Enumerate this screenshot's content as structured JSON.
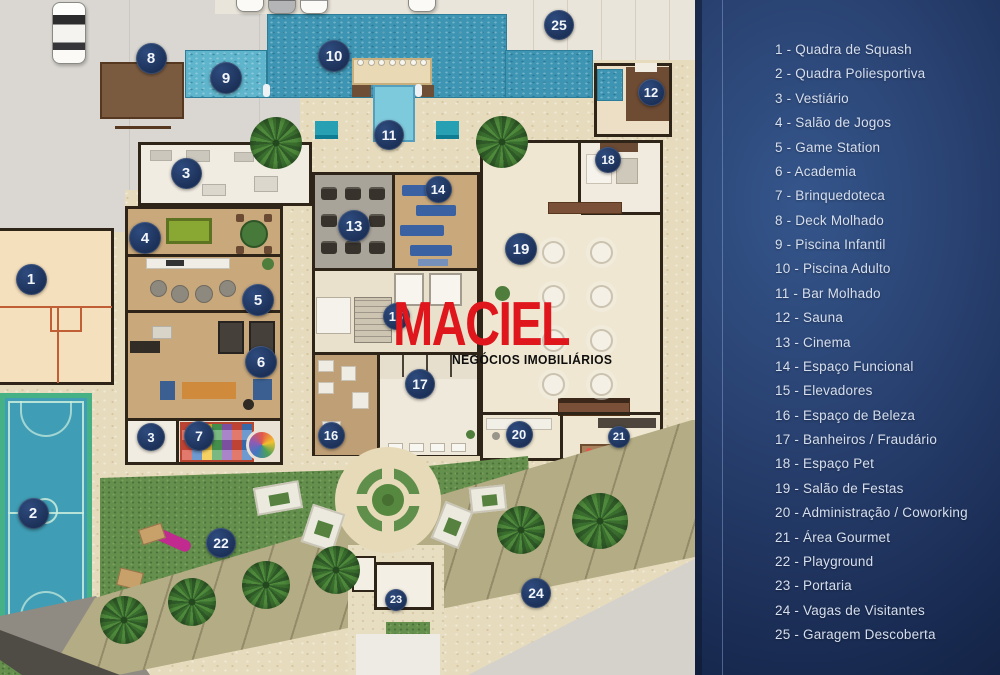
{
  "watermark": {
    "brand": "MACIEL",
    "tagline": "NEGÓCIOS IMOBILIÁRIOS"
  },
  "legend": {
    "separator": " - ",
    "items": [
      {
        "n": "1",
        "label": "Quadra de Squash"
      },
      {
        "n": "2",
        "label": "Quadra Poliesportiva"
      },
      {
        "n": "3",
        "label": "Vestiário"
      },
      {
        "n": "4",
        "label": "Salão de Jogos"
      },
      {
        "n": "5",
        "label": "Game Station"
      },
      {
        "n": "6",
        "label": "Academia"
      },
      {
        "n": "7",
        "label": "Brinquedoteca"
      },
      {
        "n": "8",
        "label": "Deck Molhado"
      },
      {
        "n": "9",
        "label": "Piscina Infantil"
      },
      {
        "n": "10",
        "label": "Piscina Adulto"
      },
      {
        "n": "11",
        "label": "Bar Molhado"
      },
      {
        "n": "12",
        "label": "Sauna"
      },
      {
        "n": "13",
        "label": "Cinema"
      },
      {
        "n": "14",
        "label": "Espaço Funcional"
      },
      {
        "n": "15",
        "label": "Elevadores"
      },
      {
        "n": "16",
        "label": "Espaço de Beleza"
      },
      {
        "n": "17",
        "label": "Banheiros / Fraudário"
      },
      {
        "n": "18",
        "label": "Espaço Pet"
      },
      {
        "n": "19",
        "label": "Salão de Festas"
      },
      {
        "n": "20",
        "label": "Administração / Coworking"
      },
      {
        "n": "21",
        "label": "Área Gourmet"
      },
      {
        "n": "22",
        "label": "Playground"
      },
      {
        "n": "23",
        "label": "Portaria"
      },
      {
        "n": "24",
        "label": "Vagas de Visitantes"
      },
      {
        "n": "25",
        "label": "Garagem Descoberta"
      }
    ]
  },
  "plan": {
    "badges": [
      {
        "n": "1",
        "x": 31,
        "y": 279,
        "s": 31
      },
      {
        "n": "2",
        "x": 33,
        "y": 513,
        "s": 31
      },
      {
        "n": "3",
        "x": 186,
        "y": 173,
        "s": 31
      },
      {
        "n": "4",
        "x": 145,
        "y": 238,
        "s": 32
      },
      {
        "n": "5",
        "x": 258,
        "y": 300,
        "s": 32
      },
      {
        "n": "6",
        "x": 261,
        "y": 362,
        "s": 32
      },
      {
        "n": "3",
        "x": 151,
        "y": 437,
        "s": 28
      },
      {
        "n": "7",
        "x": 199,
        "y": 436,
        "s": 30
      },
      {
        "n": "8",
        "x": 151,
        "y": 58,
        "s": 31
      },
      {
        "n": "9",
        "x": 226,
        "y": 78,
        "s": 32
      },
      {
        "n": "10",
        "x": 334,
        "y": 56,
        "s": 32
      },
      {
        "n": "11",
        "x": 389,
        "y": 135,
        "s": 30
      },
      {
        "n": "12",
        "x": 651,
        "y": 92,
        "s": 27
      },
      {
        "n": "13",
        "x": 354,
        "y": 226,
        "s": 32
      },
      {
        "n": "14",
        "x": 438,
        "y": 189,
        "s": 27
      },
      {
        "n": "15",
        "x": 396,
        "y": 316,
        "s": 27
      },
      {
        "n": "16",
        "x": 331,
        "y": 435,
        "s": 27
      },
      {
        "n": "17",
        "x": 420,
        "y": 384,
        "s": 30
      },
      {
        "n": "18",
        "x": 608,
        "y": 160,
        "s": 26
      },
      {
        "n": "19",
        "x": 521,
        "y": 249,
        "s": 32
      },
      {
        "n": "20",
        "x": 519,
        "y": 434,
        "s": 27
      },
      {
        "n": "21",
        "x": 619,
        "y": 437,
        "s": 22
      },
      {
        "n": "22",
        "x": 221,
        "y": 543,
        "s": 30
      },
      {
        "n": "23",
        "x": 396,
        "y": 600,
        "s": 22
      },
      {
        "n": "24",
        "x": 536,
        "y": 593,
        "s": 30
      },
      {
        "n": "25",
        "x": 559,
        "y": 25,
        "s": 30
      }
    ]
  },
  "colors": {
    "badge_navy": "#223a66",
    "sidebar_dark": "#111f3f",
    "sidebar_light": "#35568c",
    "pool_blue": "#3d95b3",
    "kids_pool_blue": "#5fb5cc",
    "grass_green": "#648f4d",
    "court_green_border": "#46b184",
    "court_blue": "#3f9db5",
    "squash_peach": "#f5e0bd",
    "watermark_red": "#e0161d",
    "legend_text": "#d7dfee"
  }
}
